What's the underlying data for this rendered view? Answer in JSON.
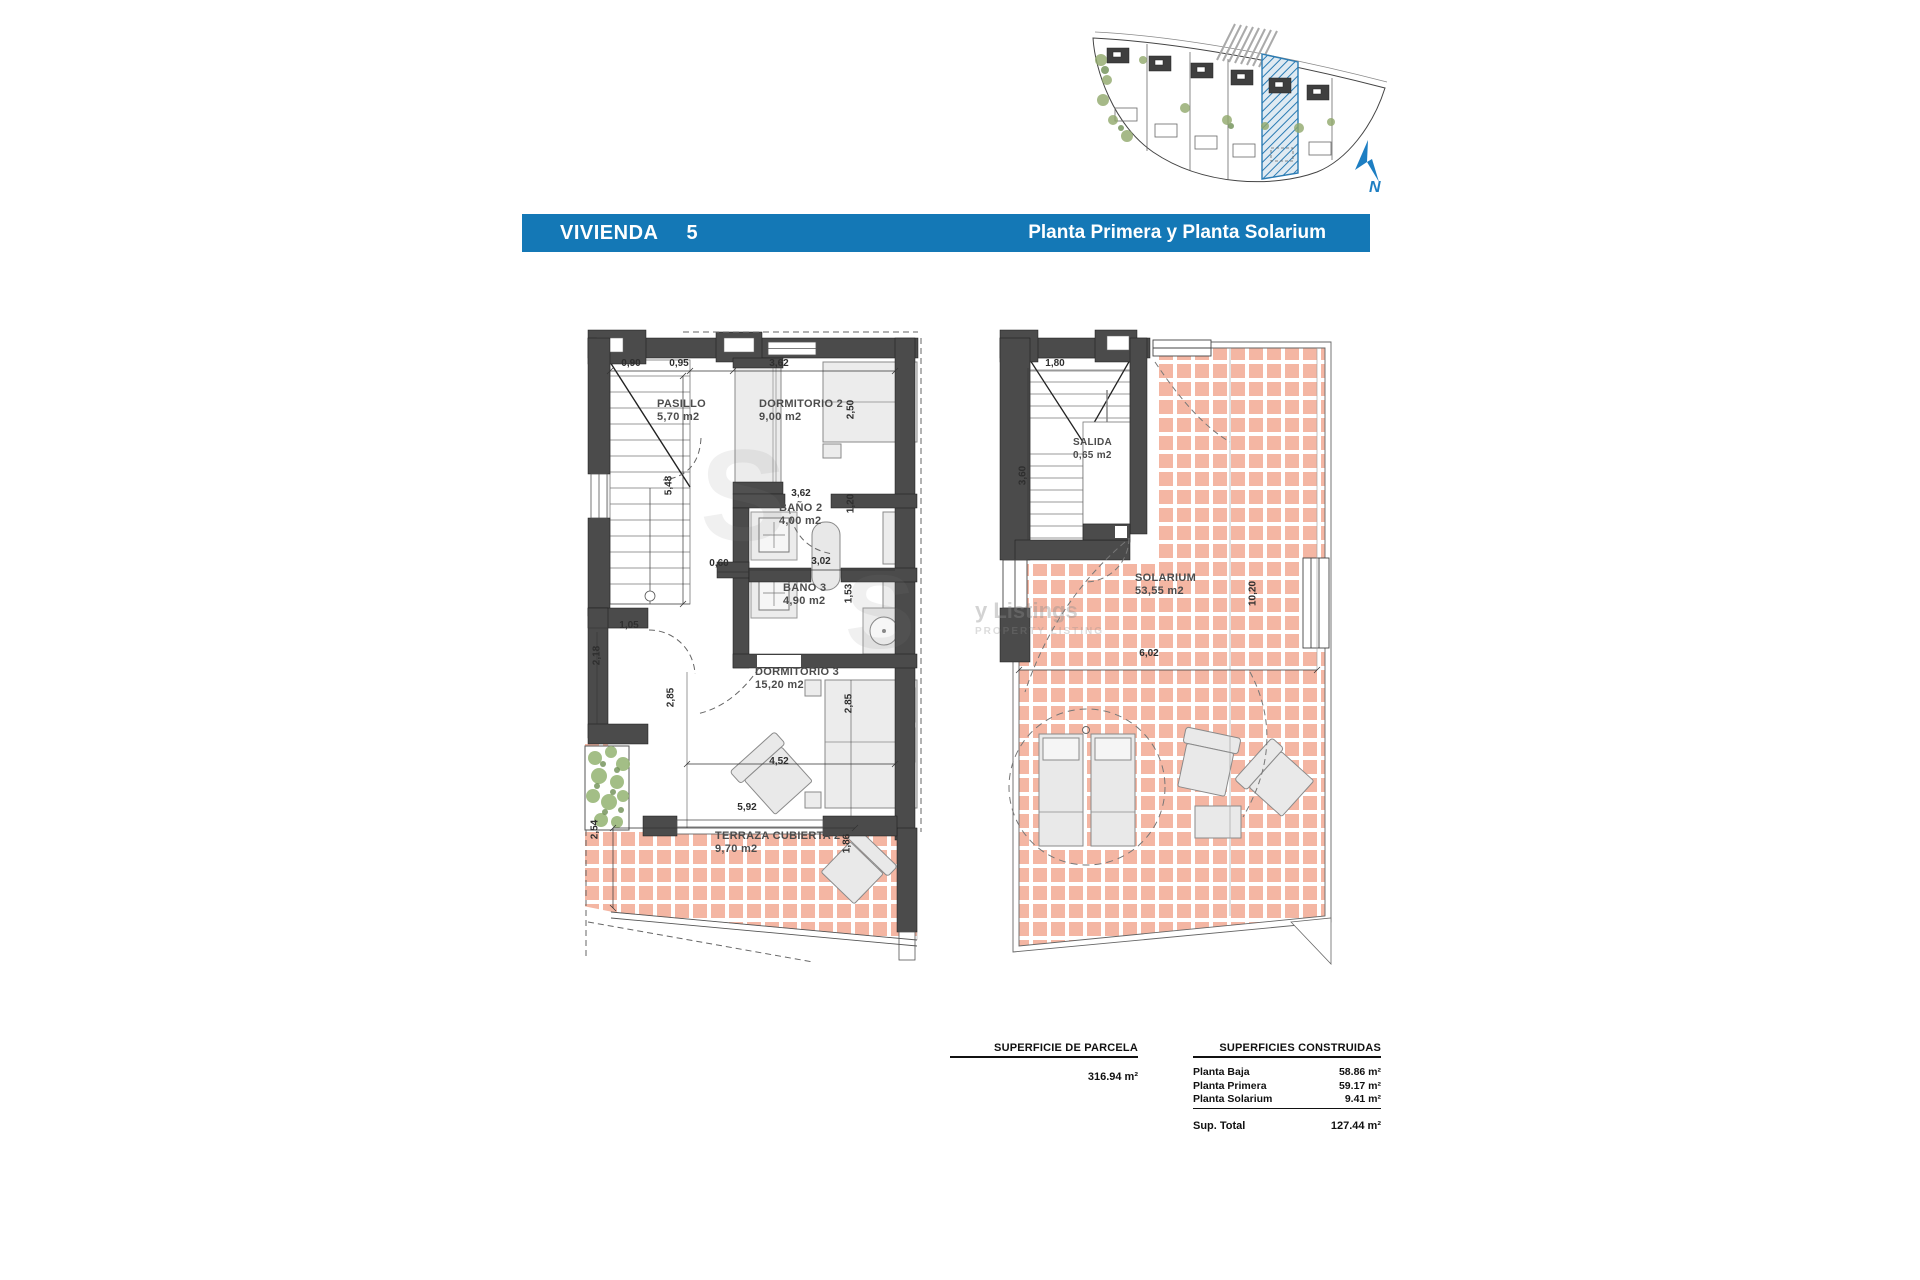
{
  "title_bar": {
    "name": "VIVIENDA",
    "number": "5",
    "subtitle": "Planta Primera y Planta Solarium"
  },
  "site_plan": {
    "north_label": "N"
  },
  "watermark": {
    "letter": "S",
    "line1": "y Listings",
    "line2": "PROPERTY LISTING"
  },
  "plan_first": {
    "rooms": [
      {
        "name": "PASILLO",
        "area": "5,70 m2"
      },
      {
        "name": "DORMITORIO 2",
        "area": "9,00 m2"
      },
      {
        "name": "BAÑO 2",
        "area": "4,00 m2"
      },
      {
        "name": "BAÑO 3",
        "area": "4,90 m2"
      },
      {
        "name": "DORMITORIO 3",
        "area": "15,20 m2"
      },
      {
        "name": "TERRAZA CUBIERTA 2",
        "area": "9,70 m2"
      }
    ],
    "dims": [
      "0,90",
      "0,95",
      "3,62",
      "2,50",
      "5,48",
      "3,62",
      "1,20",
      "0,60",
      "3,02",
      "1,53",
      "1,05",
      "2,18",
      "2,85",
      "2,85",
      "4,52",
      "5,92",
      "2,54",
      "1,86"
    ]
  },
  "plan_solarium": {
    "rooms": [
      {
        "name": "SALIDA",
        "area": "0,65 m2"
      },
      {
        "name": "SOLARIUM",
        "area": "53,55 m2"
      }
    ],
    "dims": [
      "1,80",
      "3,60",
      "10,20",
      "6,02"
    ]
  },
  "parcel_table": {
    "header": "SUPERFICIE DE PARCELA",
    "value": "316.94 m²"
  },
  "built_table": {
    "header": "SUPERFICIES CONSTRUIDAS",
    "rows": [
      {
        "label": "Planta Baja",
        "value": "58.86 m²"
      },
      {
        "label": "Planta Primera",
        "value": "59.17 m²"
      },
      {
        "label": "Planta Solarium",
        "value": "9.41 m²"
      }
    ],
    "total_label": "Sup. Total",
    "total_value": "127.44 m²"
  }
}
